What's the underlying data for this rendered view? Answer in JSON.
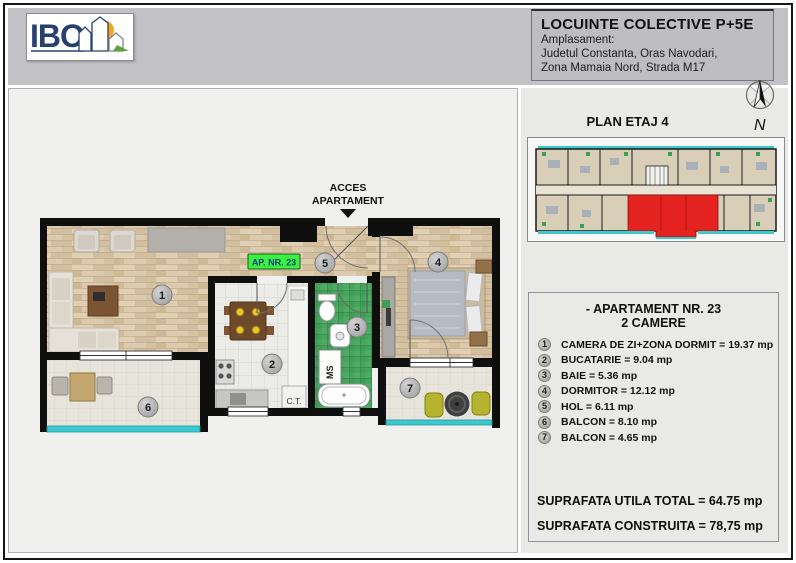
{
  "header": {
    "logo_text": "IBO",
    "project_title": "LOCUINTE COLECTIVE P+5E",
    "location_label": "Amplasament:",
    "location_line1": "Judetul Constanta, Oras Navodari,",
    "location_line2": "Zona Mamaia Nord,  Strada M17"
  },
  "plan_overview": {
    "title": "PLAN ETAJ 4",
    "compass_label": "N",
    "highlight_color": "#e42320"
  },
  "apartment_info": {
    "title": "- APARTAMENT NR. 23",
    "subtitle": "2 CAMERE",
    "rooms": [
      {
        "num": "1",
        "label": "CAMERA DE ZI+ZONA DORMIT = 19.37 mp"
      },
      {
        "num": "2",
        "label": "BUCATARIE = 9.04 mp"
      },
      {
        "num": "3",
        "label": "BAIE = 5.36 mp"
      },
      {
        "num": "4",
        "label": "DORMITOR = 12.12 mp"
      },
      {
        "num": "5",
        "label": "HOL = 6.11 mp"
      },
      {
        "num": "6",
        "label": "BALCON = 8.10 mp"
      },
      {
        "num": "7",
        "label": "BALCON = 4.65 mp"
      }
    ],
    "total_useful": "SUPRAFATA UTILA TOTAL = 64.75 mp",
    "total_built": "SUPRAFATA CONSTRUITA = 78,75 mp"
  },
  "floorplan": {
    "access_line1": "ACCES",
    "access_line2": "APARTAMENT",
    "unit_tag": "AP. NR. 23",
    "boiler_label": "C.T.",
    "washer_label": "MS",
    "rooms": [
      "1",
      "2",
      "3",
      "4",
      "5",
      "6",
      "7"
    ],
    "colors": {
      "tag_bg": "#38f23e",
      "balcony_rail": "#3cc8cd"
    }
  }
}
